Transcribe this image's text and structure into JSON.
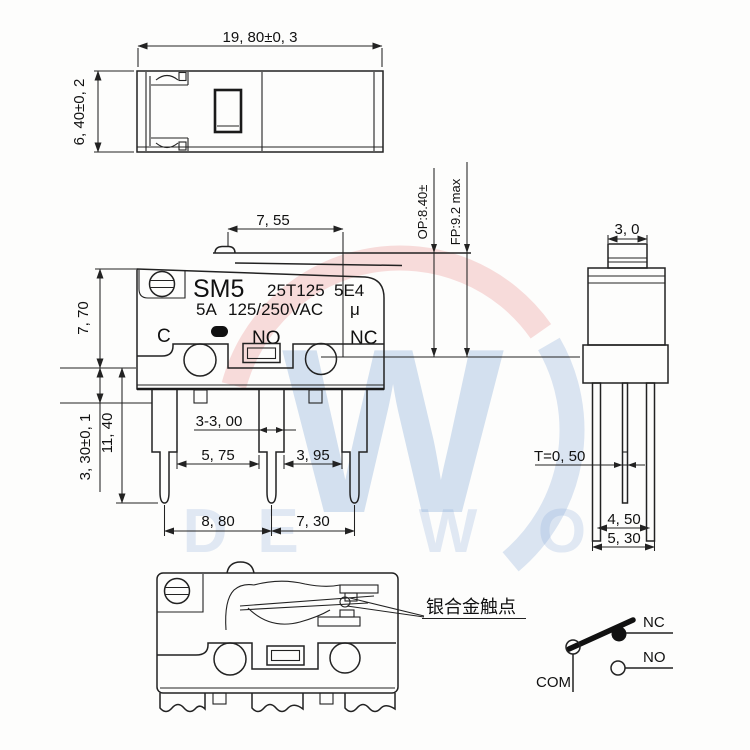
{
  "watermark": {
    "monogram": "W",
    "brand": [
      "D",
      "E",
      "W",
      "O"
    ],
    "colors": {
      "red_arc": "rgba(225,85,85,0.20)",
      "blue_arc": "rgba(95,140,205,0.22)",
      "monogram_blue": "rgba(105,150,205,0.28)",
      "brand_blue": "rgba(125,160,215,0.22)"
    }
  },
  "top_view": {
    "dim_width": "19, 80±0, 3",
    "dim_height": "6, 40±0, 2"
  },
  "front_view": {
    "model": "SM5",
    "code_left": "25T125",
    "code_right": "5E4",
    "rating_current": "5A",
    "rating_voltage": "125/250VAC",
    "mu": "μ",
    "terminal_c": "C",
    "terminal_no": "NO",
    "terminal_nc": "NC",
    "dim_lever": "7, 55",
    "dim_body_height": "7, 70",
    "dim_pin_step": "3, 30±0, 1",
    "dim_pin_length": "11, 40",
    "dim_pin_width": "3-3, 00",
    "dim_gap_left": "5, 75",
    "dim_gap_right": "3, 95",
    "dim_pitch_left": "8, 80",
    "dim_pitch_right": "7, 30",
    "dim_op": "OP:8.40±",
    "dim_fp": "FP:9.2 max"
  },
  "side_view": {
    "dim_button": "3, 0",
    "dim_thickness": "T=0, 50",
    "dim_pin_inner": "4, 50",
    "dim_pin_outer": "5, 30"
  },
  "section_view": {
    "callout": "银合金触点"
  },
  "circuit": {
    "com": "COM",
    "nc": "NC",
    "no": "NO"
  }
}
